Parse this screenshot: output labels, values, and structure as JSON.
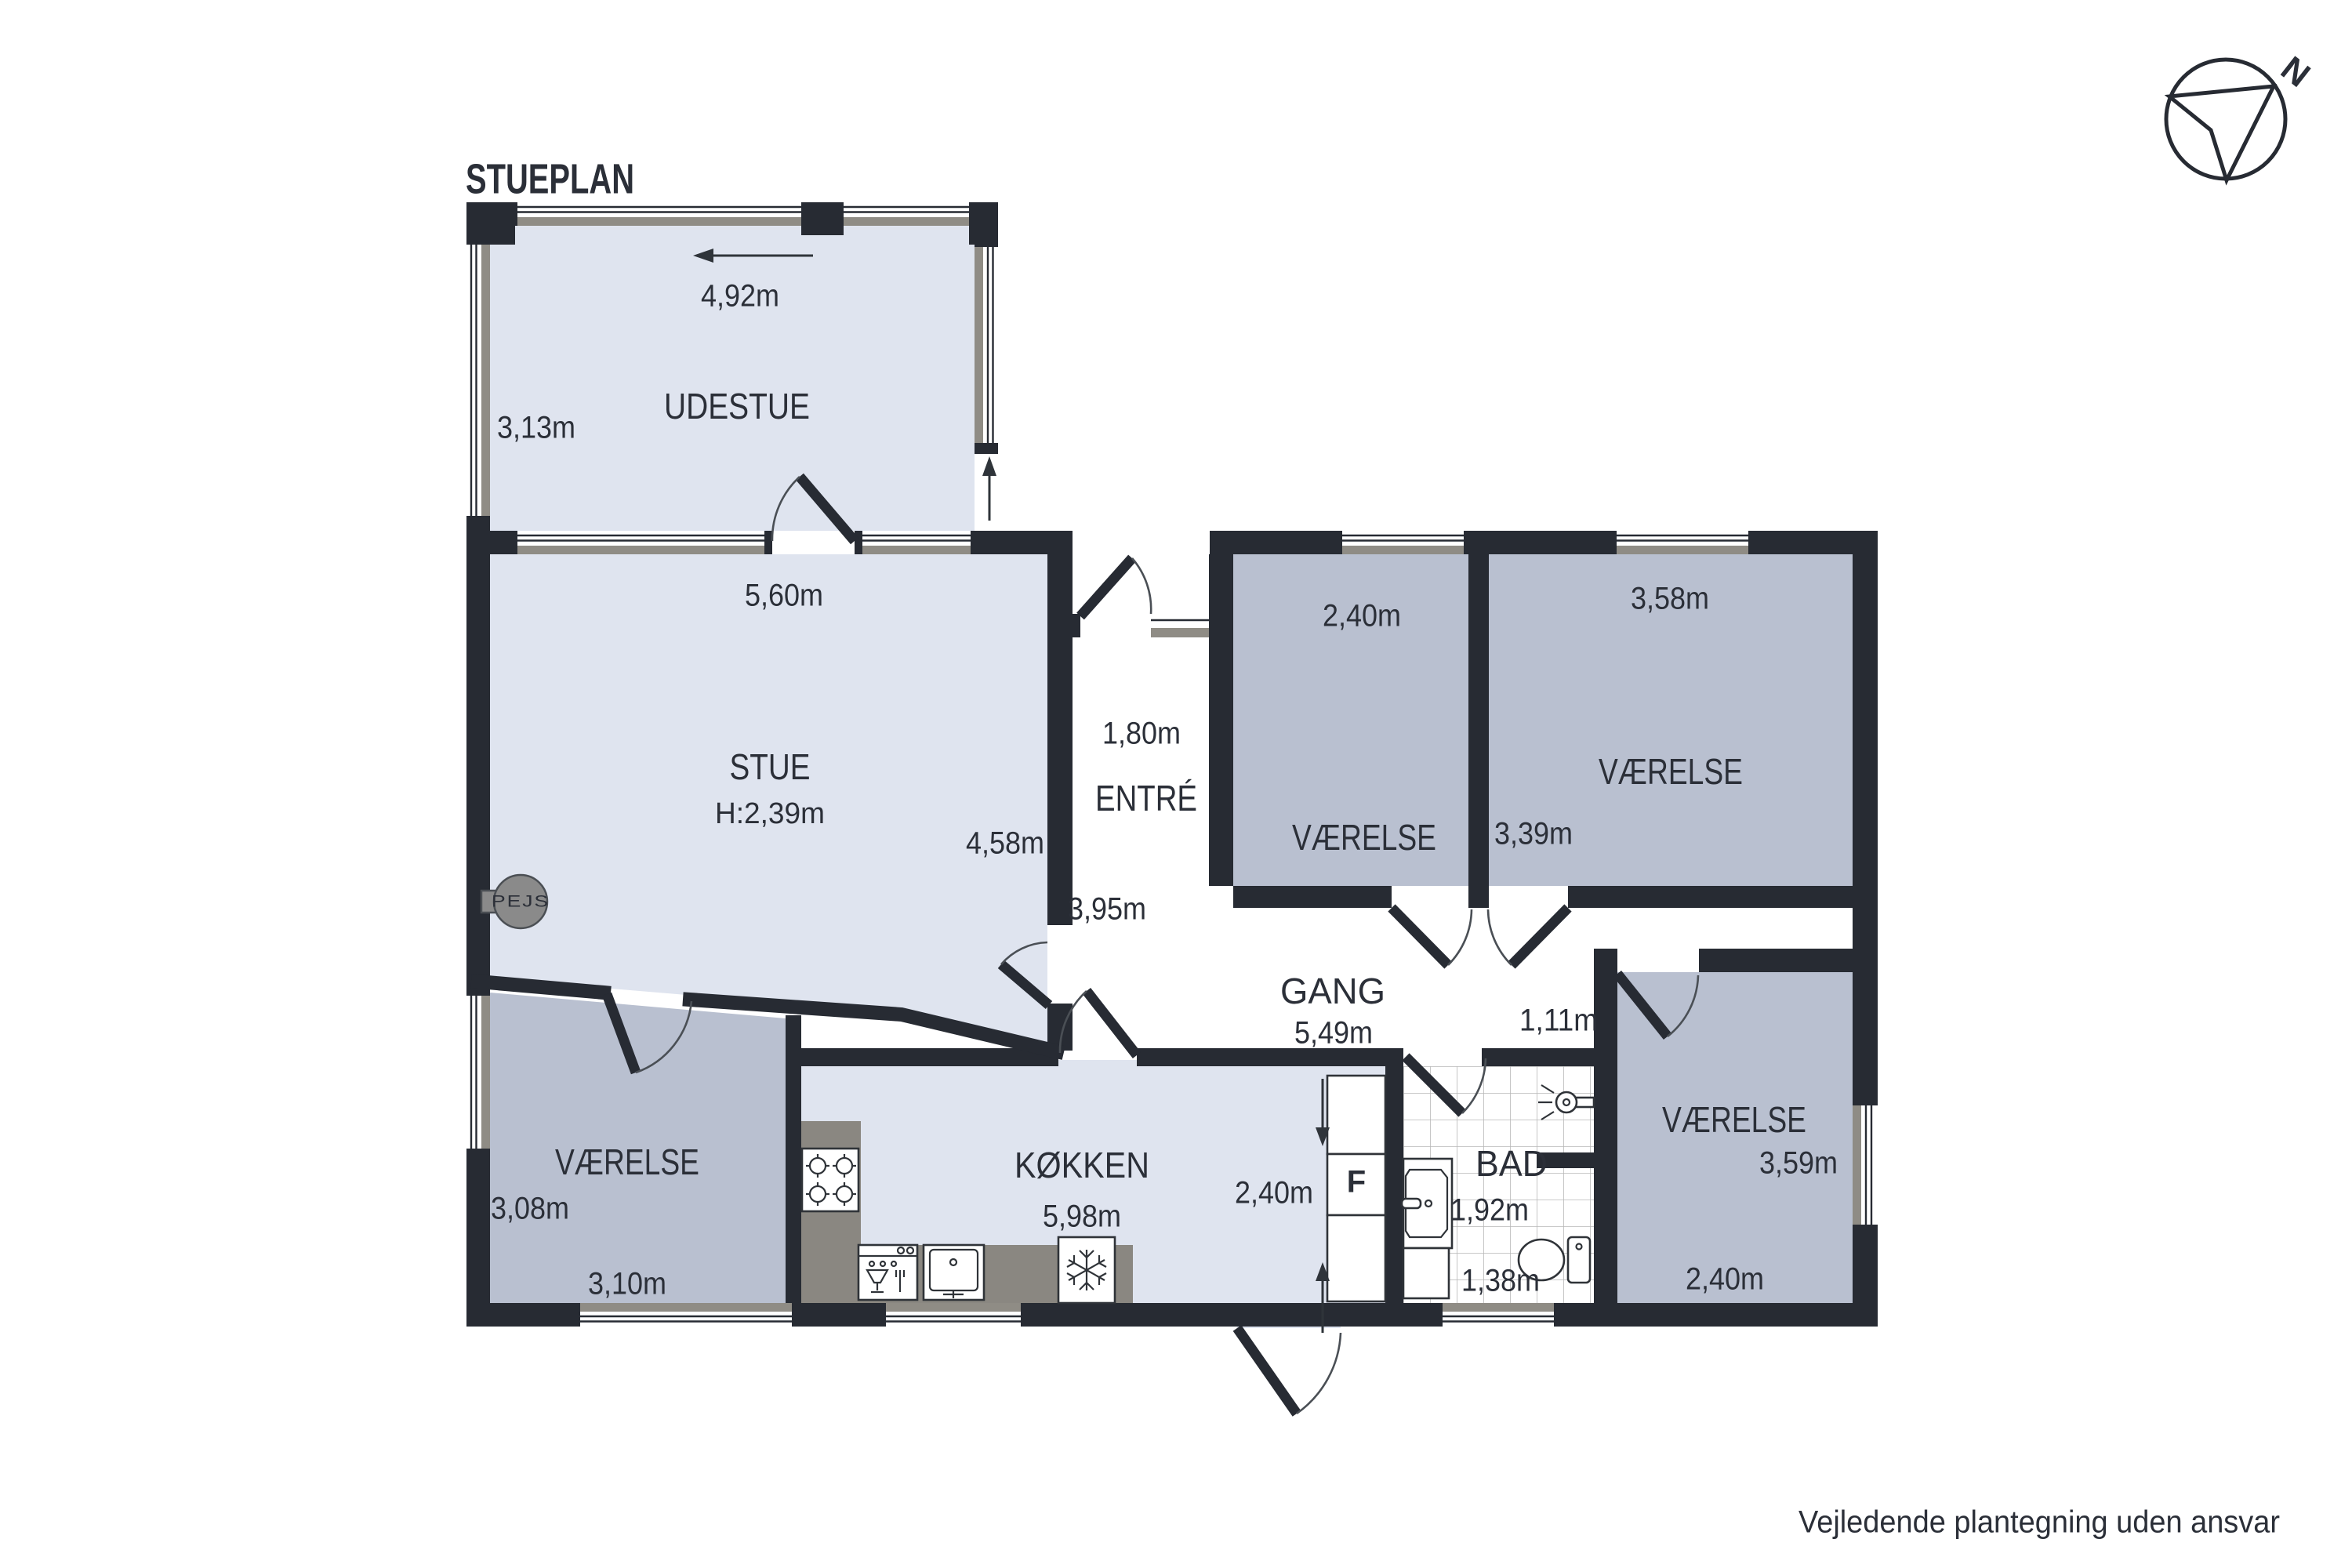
{
  "title": "STUEPLAN",
  "disclaimer": "Vejledende plantegning uden ansvar",
  "compass": {
    "north_label": "N"
  },
  "fireplace_label": "PEJS",
  "cabinet_label": "F",
  "rooms": [
    {
      "id": "udestue",
      "name": "UDESTUE",
      "measurements": [
        "4,92m",
        "3,13m"
      ]
    },
    {
      "id": "stue",
      "name": "STUE",
      "ceiling_height": "H:2,39m",
      "measurements": [
        "5,60m",
        "4,58m"
      ]
    },
    {
      "id": "entre",
      "name": "ENTRÉ",
      "measurements": [
        "1,80m",
        "3,95m"
      ]
    },
    {
      "id": "vaerelse-nord-1",
      "name": "VÆRELSE",
      "measurements": [
        "2,40m"
      ]
    },
    {
      "id": "vaerelse-nord-2",
      "name": "VÆRELSE",
      "measurements": [
        "3,58m",
        "3,39m"
      ]
    },
    {
      "id": "gang",
      "name": "GANG",
      "measurements": [
        "5,49m",
        "1,11m"
      ]
    },
    {
      "id": "vaerelse-vest",
      "name": "VÆRELSE",
      "measurements": [
        "3,08m",
        "3,10m"
      ]
    },
    {
      "id": "koekken",
      "name": "KØKKEN",
      "measurements": [
        "5,98m",
        "2,40m"
      ]
    },
    {
      "id": "bad",
      "name": "BAD",
      "measurements": [
        "1,92m",
        "1,38m"
      ]
    },
    {
      "id": "vaerelse-syd",
      "name": "VÆRELSE",
      "measurements": [
        "3,59m",
        "2,40m"
      ]
    }
  ],
  "colors": {
    "wall": "#272b33",
    "room_light": "#dfe4ef",
    "room_medium": "#b9c0d0",
    "counter": "#8a8781",
    "window_sill": "#8f8c85",
    "fireplace": "#8a8a8a",
    "text": "#2b2f38"
  }
}
